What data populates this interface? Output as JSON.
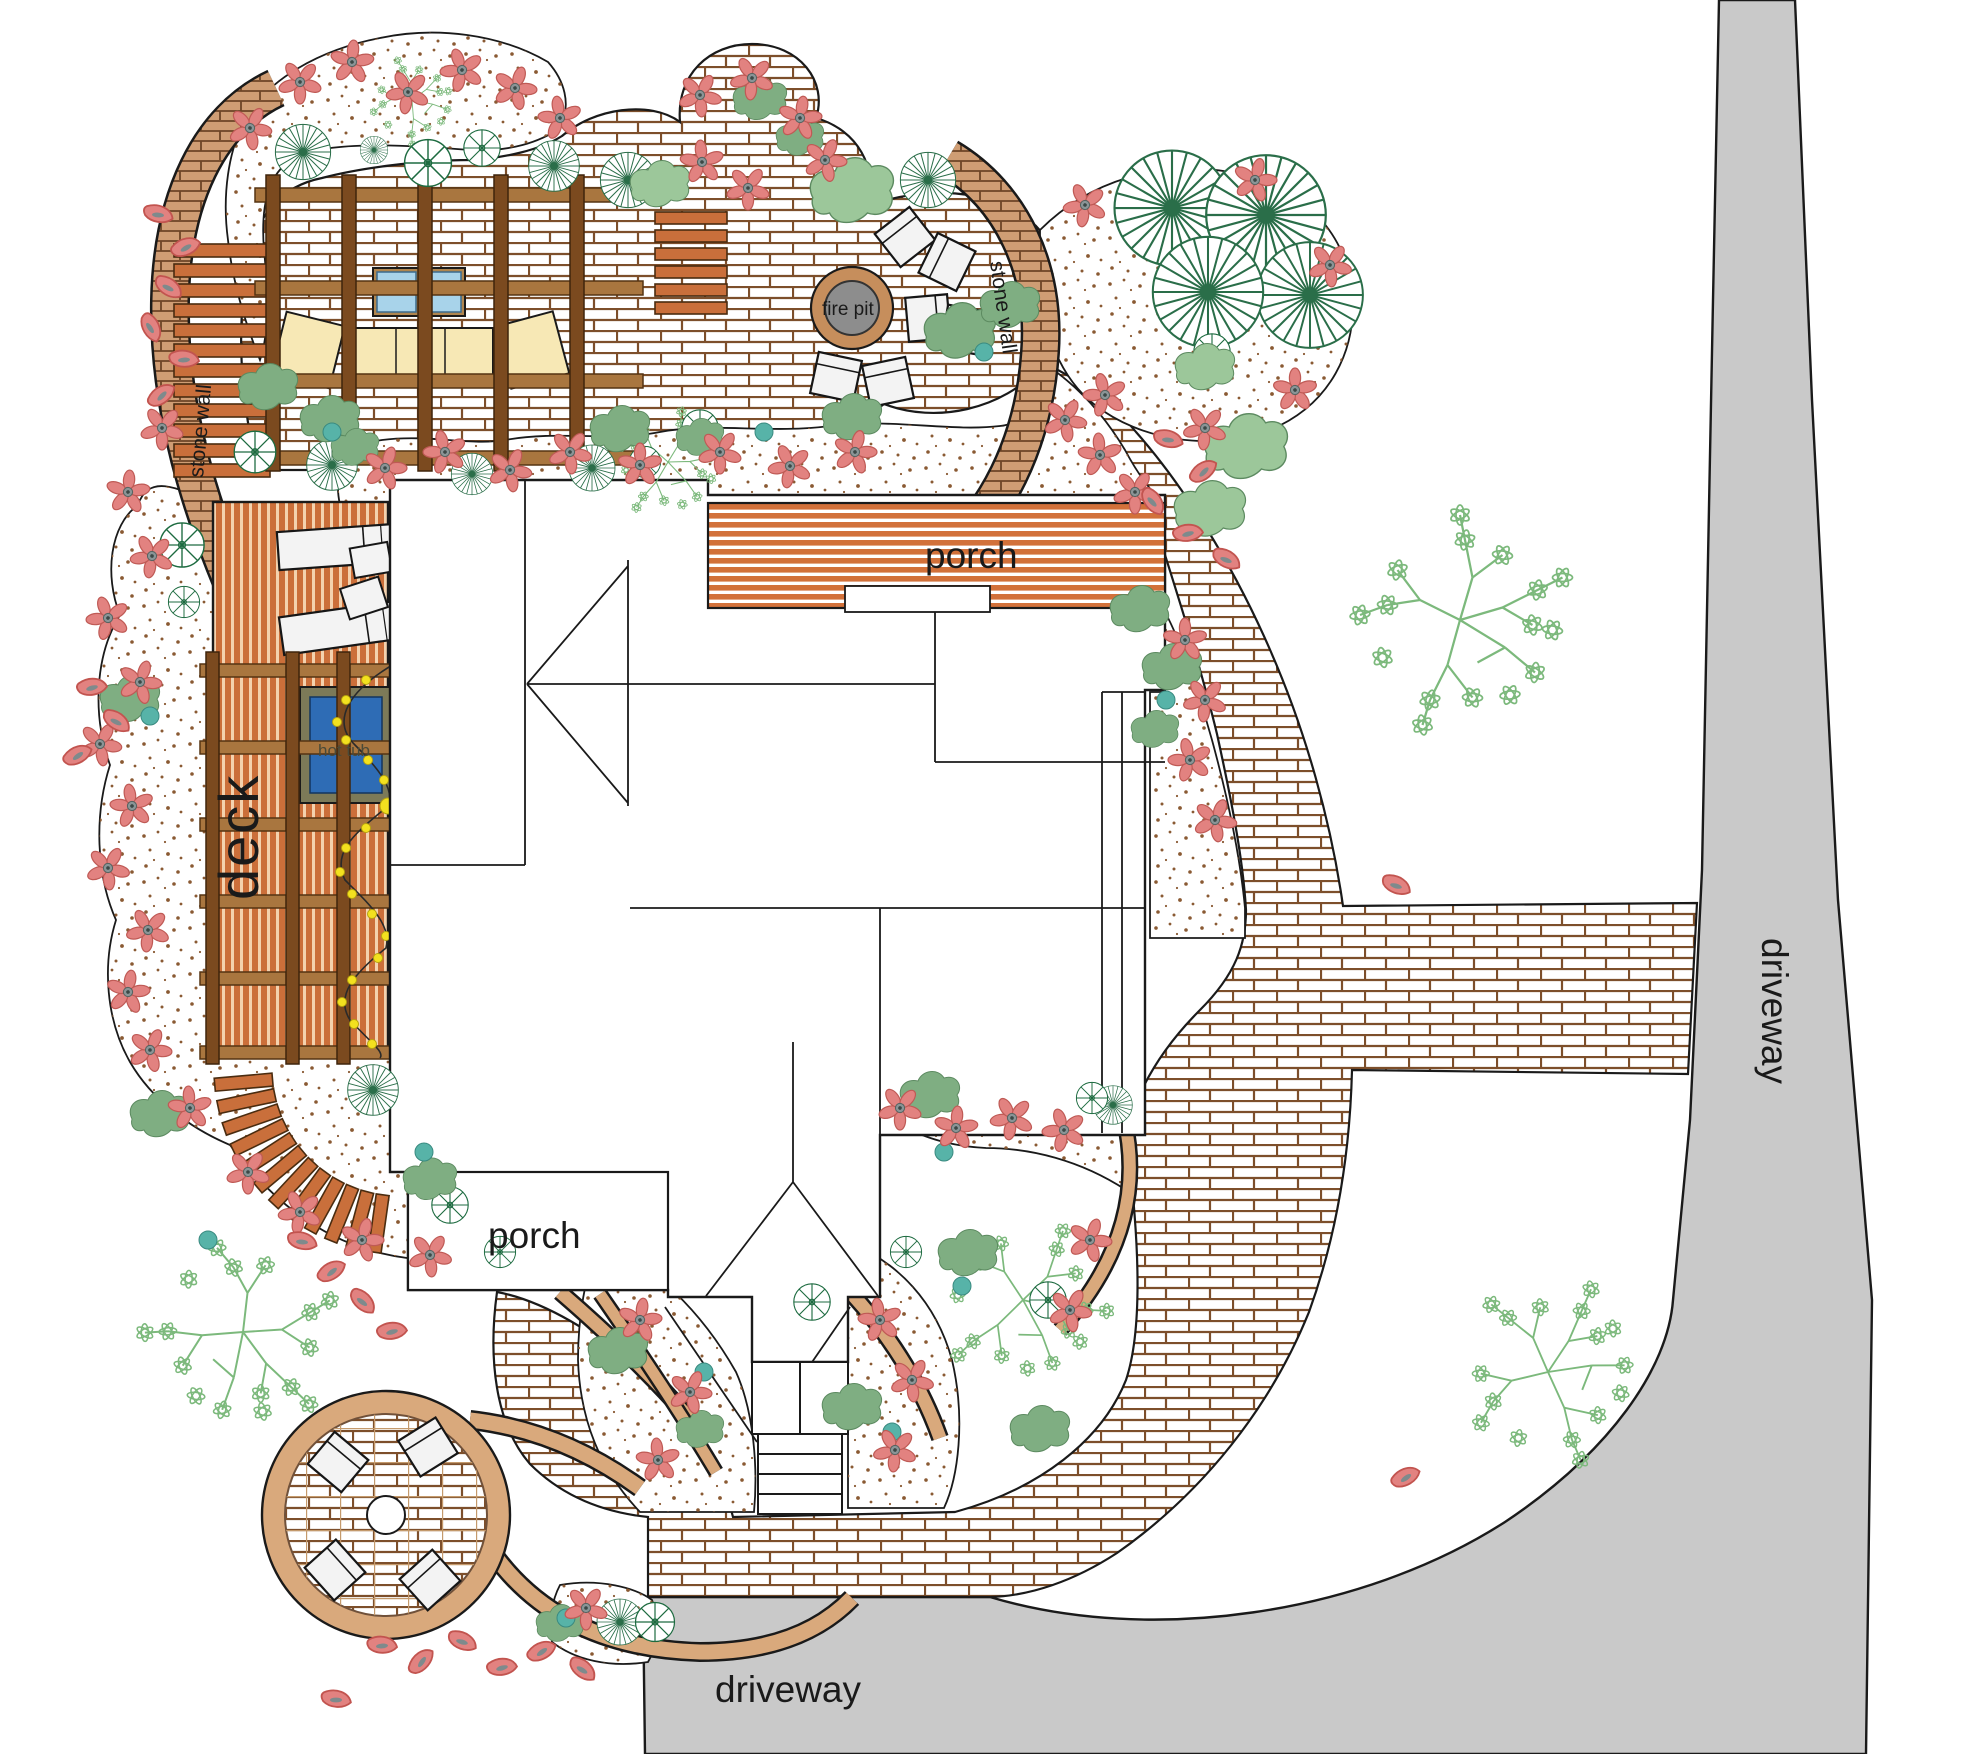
{
  "plan": {
    "title": "residential landscape plan",
    "labels": {
      "deck": "deck",
      "hot_tub": "hot tub",
      "fire_pit": "fire pit",
      "stone_wall_left": "stone wall",
      "stone_wall_right": "stone wall",
      "porch_north": "porch",
      "porch_south": "porch",
      "driveway_east": "driveway",
      "driveway_south": "driveway"
    },
    "features": [
      "house",
      "north porch",
      "south porch",
      "deck",
      "hot tub with pergola and string lights",
      "pergola lounge with sofa and table",
      "fire pit with chairs",
      "stone walls",
      "brick patio",
      "brick walkway",
      "circular patio with chairs",
      "front stoop and steps",
      "curved deck steps",
      "driveway",
      "lawn",
      "planting beds",
      "trees",
      "shrubs",
      "flowers"
    ],
    "colors": {
      "driveway_gray": "#c9c9c9",
      "brick_line": "#7d4f2b",
      "stone_wall_tan": "#cf9d74",
      "edging_tan": "#d9a97c",
      "deck_board_orange": "#cb6f3a",
      "porch_board_orange": "#d2713a",
      "pergola_wood": "#8a5a2b",
      "hot_tub_blue": "#2e6cb5",
      "fire_pit_gray": "#8d8d8d",
      "flower_red": "#e28280",
      "shrub_green": "#7fae82",
      "teal_accent": "#57b3a8",
      "conifer_green": "#2a6e49",
      "light_tree_green": "#7cb97c",
      "cushion_tan": "#f7e8b5"
    }
  }
}
